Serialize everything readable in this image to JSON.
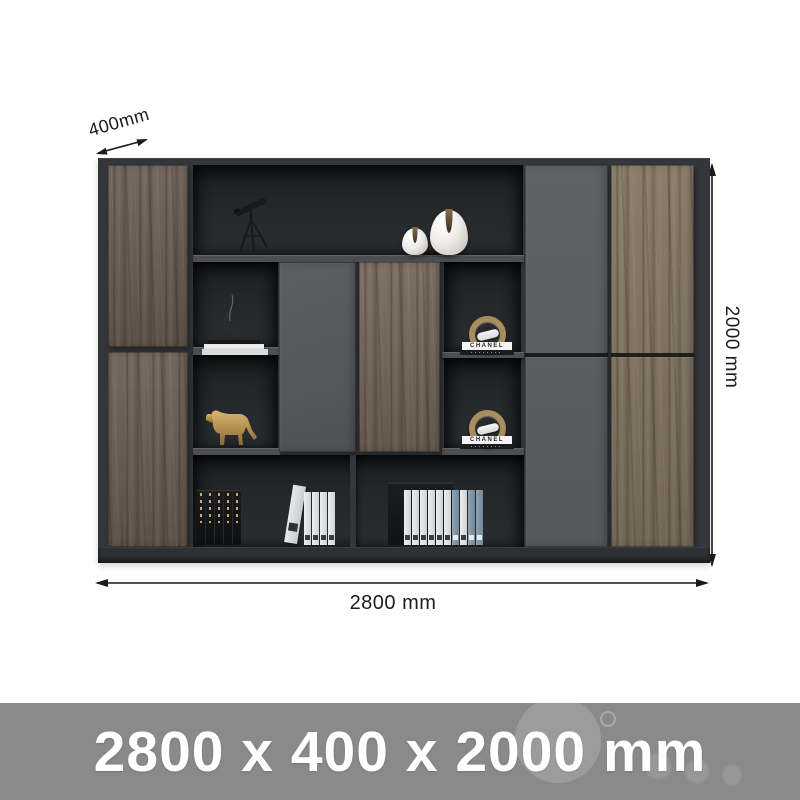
{
  "theme": {
    "page_bg": "#ffffff",
    "dim_color": "#1c1c1c",
    "banner_bg": "#8a8a8a",
    "banner_text": "#ffffff",
    "frame": "#33363a",
    "base": "#2d3034",
    "back": "#26282b",
    "back_dark": "#1e2023",
    "shelf": "#4b4e52",
    "gray_door": "#55585c",
    "gray_door_right": "#5f6266",
    "wood_left": "#685c50",
    "wood_center": "#726557",
    "wood_right": "#81735f",
    "gold": "#b08d52"
  },
  "annotations": {
    "depth_label": "400mm",
    "height_label": "2000 mm",
    "width_label": "2800 mm"
  },
  "banner": {
    "size_text": "2800 x 400 x 2000 mm"
  },
  "decor": {
    "chanel_label": "CHANEL"
  }
}
